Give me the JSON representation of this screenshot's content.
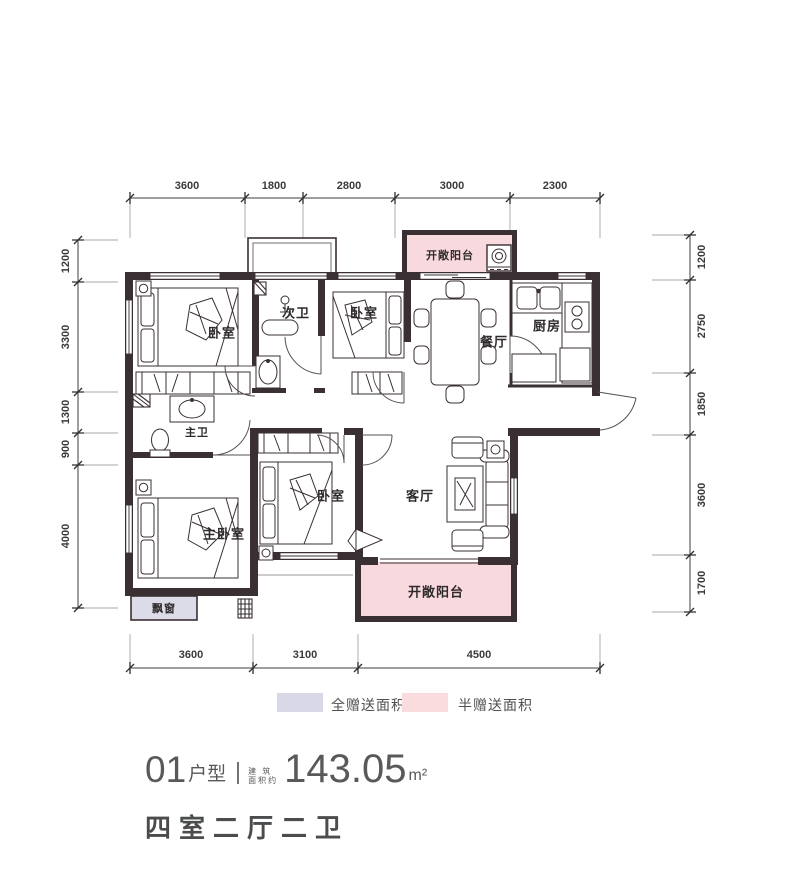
{
  "colors": {
    "wall": "#3a3033",
    "half_gift_fill": "#f8d9de",
    "full_gift_fill": "#dcdce9",
    "legend_full": "#d8d8e6",
    "legend_half": "#fadbde",
    "dim_line": "#3c3c3c",
    "title_text": "#58595b"
  },
  "dims": {
    "top": [
      "3600",
      "1800",
      "2800",
      "3000",
      "2300"
    ],
    "left": [
      "1200",
      "3300",
      "1300",
      "900",
      "4000"
    ],
    "right": [
      "1200",
      "2750",
      "1850",
      "3600",
      "1700"
    ],
    "bottom": [
      "3600",
      "3100",
      "4500"
    ]
  },
  "rooms": {
    "bedroom1": "卧室",
    "second_bath": "次卫",
    "bedroom2": "卧室",
    "dining": "餐厅",
    "kitchen": "厨房",
    "master_bath": "主卫",
    "master_bedroom": "主卧室",
    "bedroom3": "卧室",
    "living": "客厅",
    "balcony_top": "开敞阳台",
    "balcony_bottom": "开敞阳台",
    "bay_window": "飘窗"
  },
  "legend": {
    "full": {
      "label": "全赠送面积",
      "color": "#d8d8e6"
    },
    "half": {
      "label": "半赠送面积",
      "color": "#fadbde"
    }
  },
  "title": {
    "unit_no": "01",
    "unit_type": "户型",
    "area_prefix_top": "建 筑",
    "area_prefix_bottom": "面积约",
    "area_value": "143.05",
    "area_unit": "m²",
    "layout": "四室二厅二卫"
  }
}
